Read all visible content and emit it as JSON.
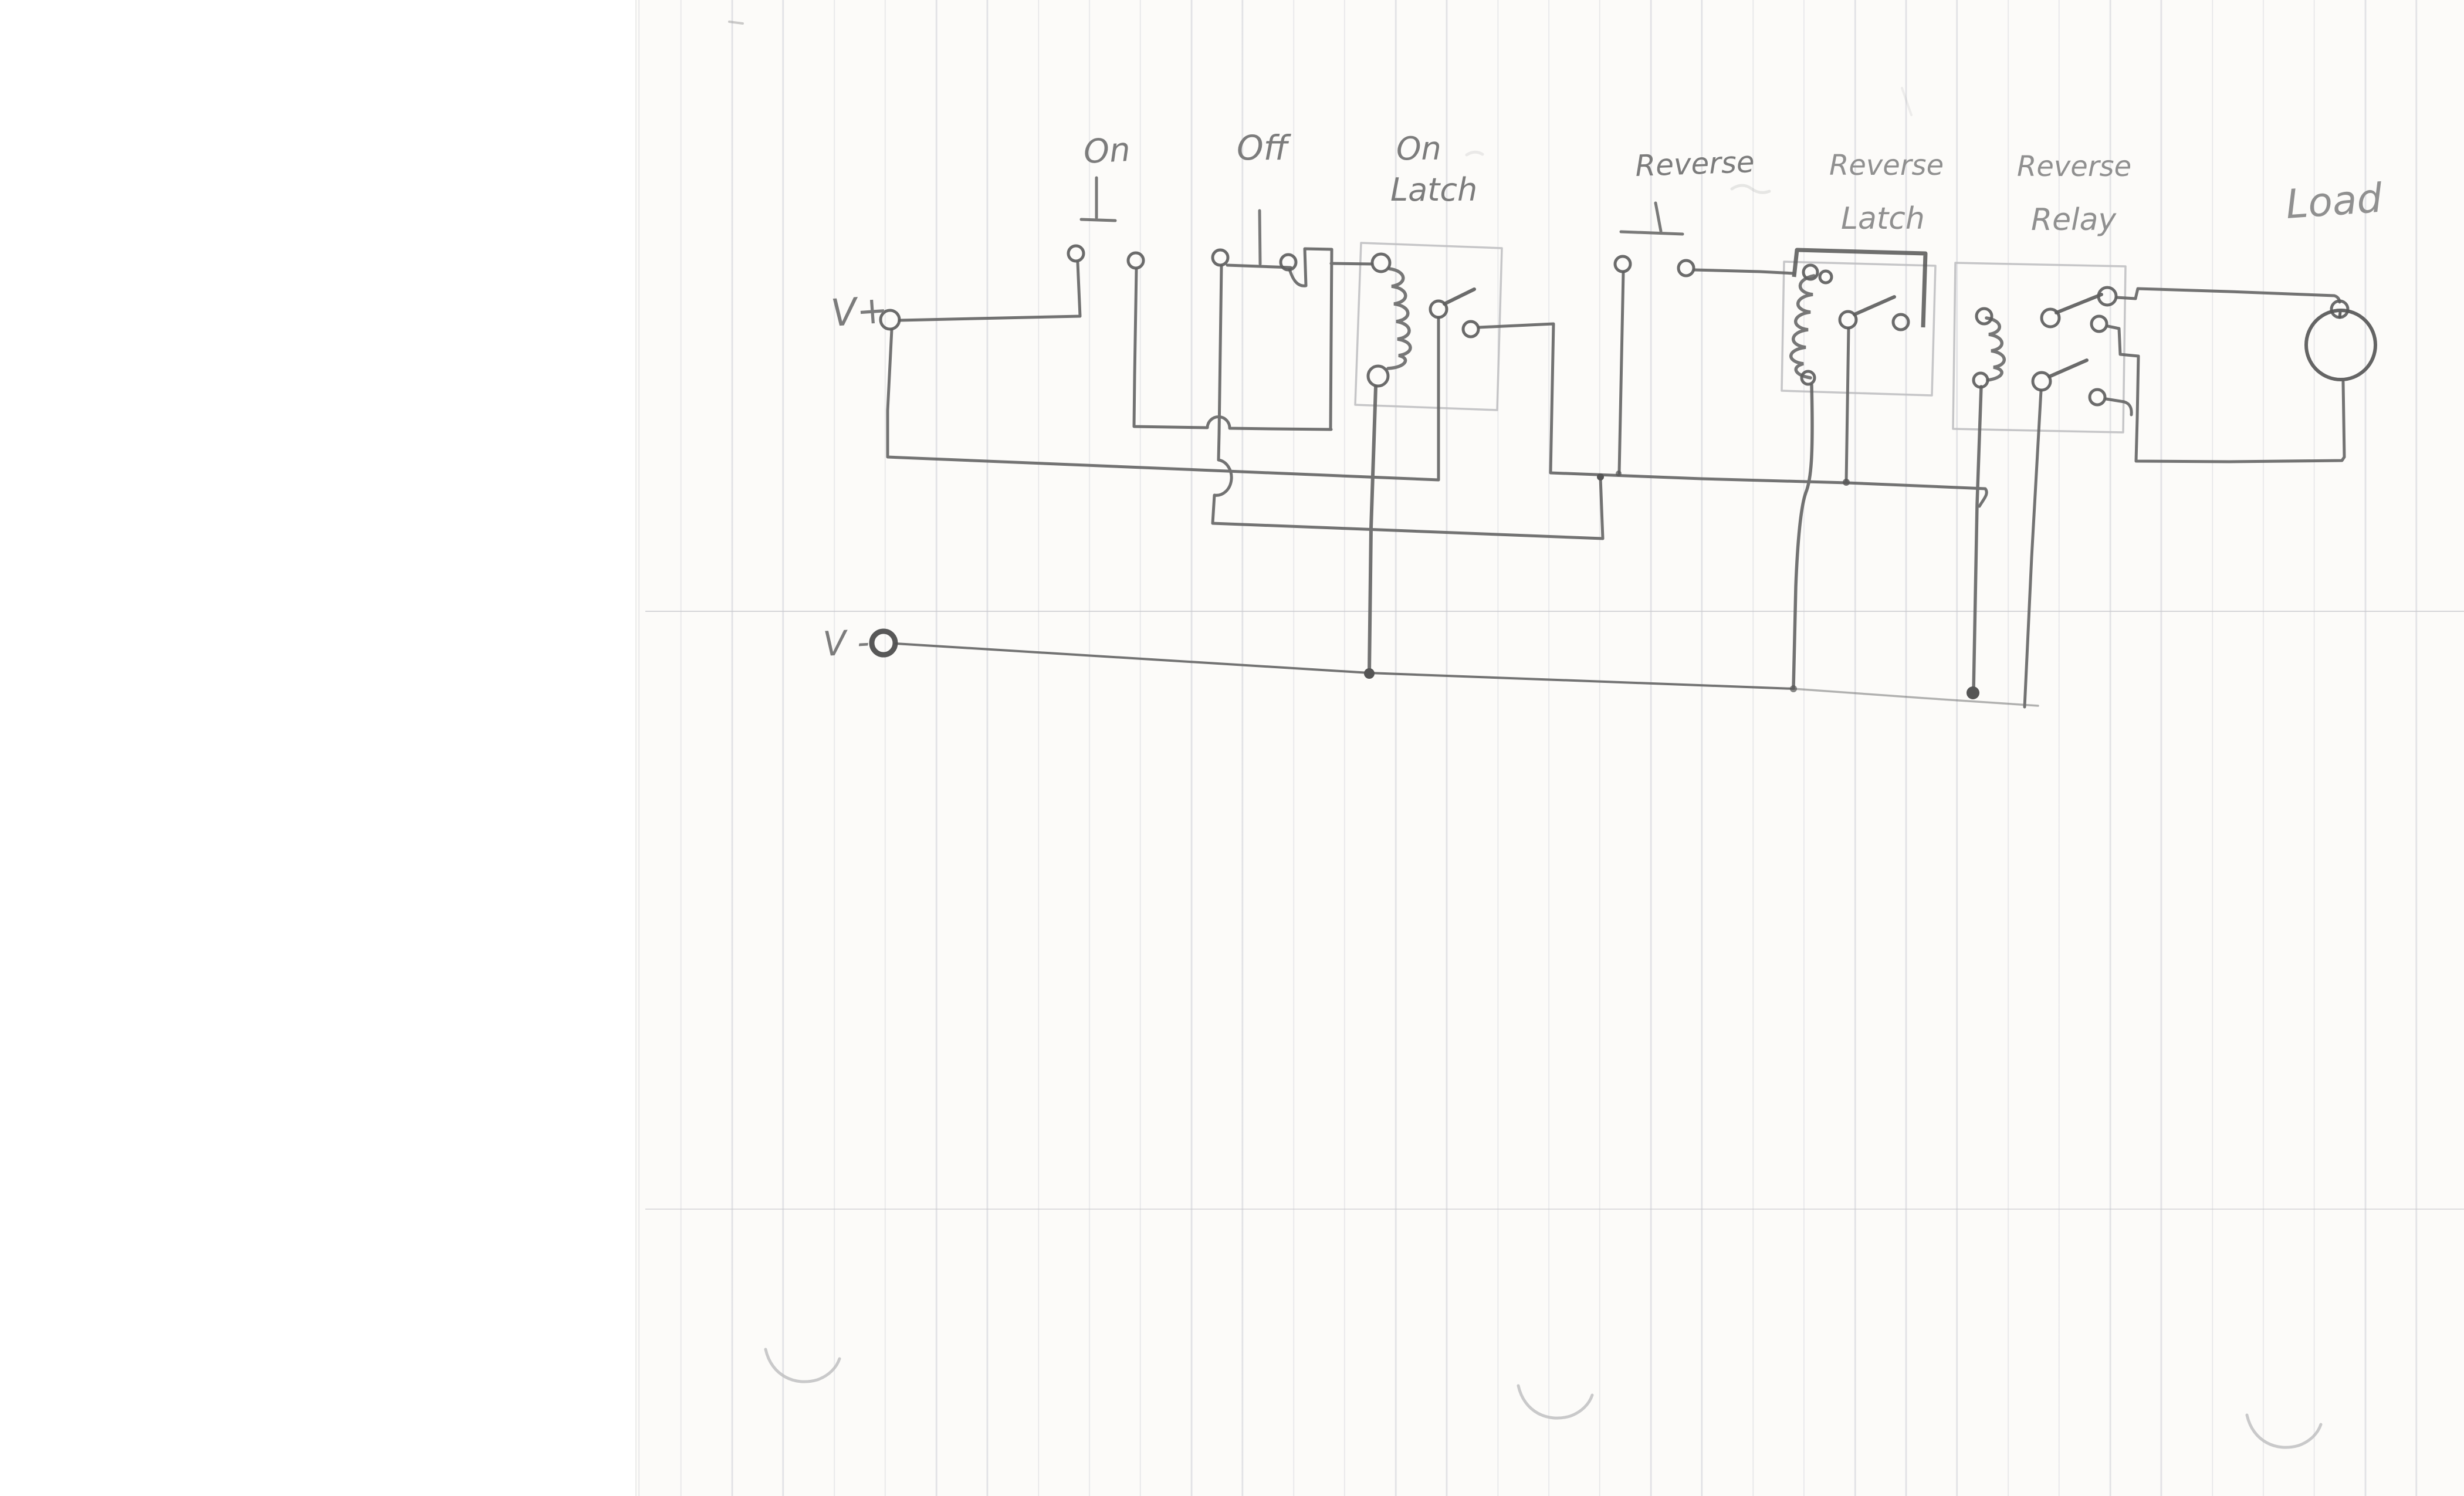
{
  "meta": {
    "description": "Hand-drawn pencil schematic of a latching relay control circuit on ruled paper",
    "diagram_type": "circuit-schematic"
  },
  "labels": {
    "v_plus": "V+",
    "on": "On",
    "off": "Off",
    "on_latch_line1": "On",
    "on_latch_line2": "Latch",
    "reverse": "Reverse",
    "reverse_latch_line1": "Reverse",
    "reverse_latch_line2": "Latch",
    "reverse_relay_line1": "Reverse",
    "reverse_relay_line2": "Relay",
    "load": "Load",
    "v_minus": "V -"
  },
  "colors": {
    "pencil": "#676767",
    "pencil_dark": "#4f4f4f",
    "pencil_light": "#c0c0c2",
    "paper": "#fcfbf9",
    "ruled_line": "#adb0be",
    "margin_line": "#c8c8cc",
    "scan_background": "#ffffff"
  },
  "components": [
    "v-plus-terminal",
    "on-pushbutton",
    "off-pushbutton",
    "on-latch-relay",
    "reverse-pushbutton",
    "reverse-latch-relay",
    "reverse-relay",
    "load-motor",
    "v-minus-terminal"
  ]
}
